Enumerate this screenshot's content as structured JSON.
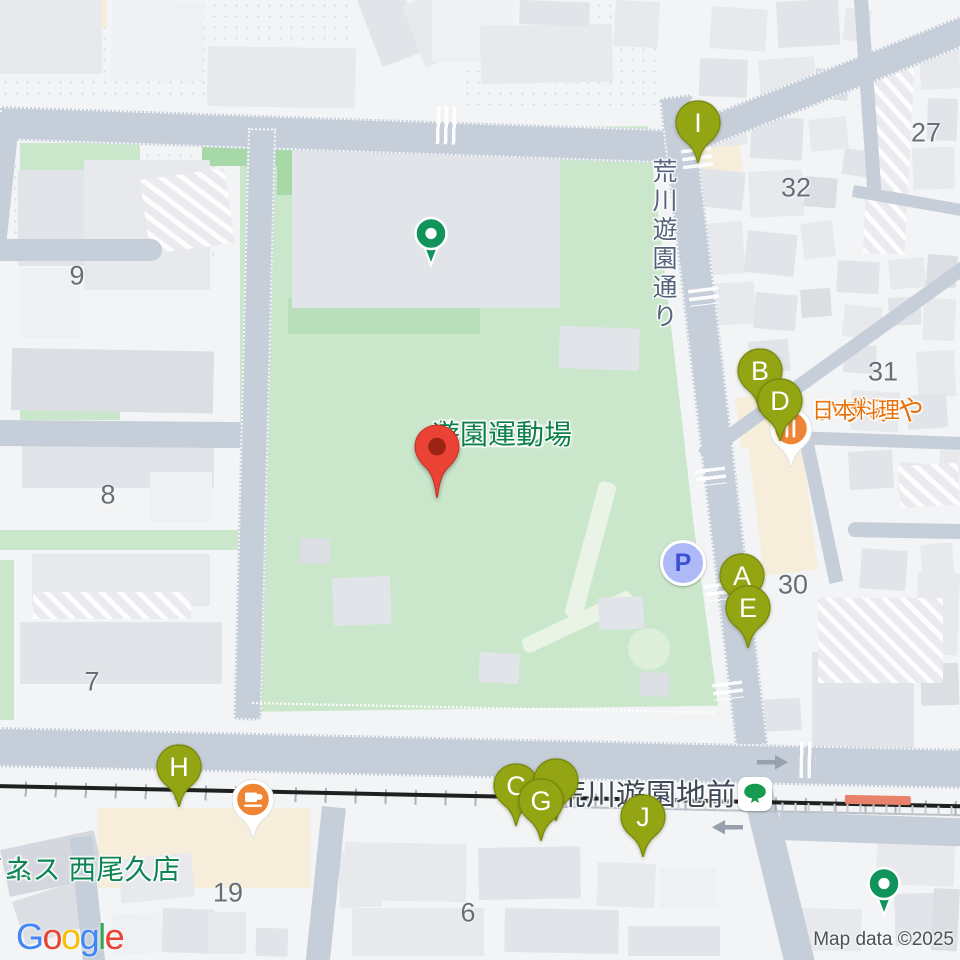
{
  "attribution": "Map data ©2025",
  "google_logo": {
    "letters": [
      {
        "ch": "G",
        "color": "#4285F4"
      },
      {
        "ch": "o",
        "color": "#EA4335"
      },
      {
        "ch": "o",
        "color": "#FBBC05"
      },
      {
        "ch": "g",
        "color": "#4285F4"
      },
      {
        "ch": "l",
        "color": "#34A853"
      },
      {
        "ch": "e",
        "color": "#EA4335"
      }
    ]
  },
  "parking_label": "P",
  "poi_labels": [
    {
      "name": "sports-house-label",
      "lines": [
        {
          "text": "あらかわ遊園",
          "size": 28
        },
        {
          "text": "スポーツハウス",
          "size": 27
        }
      ],
      "x": 402,
      "y": 203,
      "align": "right",
      "line_height": 31,
      "color": "green",
      "interactable": true
    },
    {
      "name": "ground-label",
      "lines": [
        {
          "text": "荒川区立",
          "size": 28
        },
        {
          "text": "あらかわ",
          "size": 28
        },
        {
          "text": "遊園運動場",
          "size": 28
        }
      ],
      "x": 432,
      "y": 420,
      "align": "center",
      "line_height": 29,
      "color": "green",
      "interactable": false
    },
    {
      "name": "street-name-label",
      "lines": [
        {
          "text": "荒川遊園通り",
          "size": 25
        }
      ],
      "x": 676,
      "y": 158,
      "align": "center",
      "line_height": 27,
      "color": "street",
      "vertical": true,
      "interactable": false
    },
    {
      "name": "station-name-label",
      "lines": [
        {
          "text": "荒川遊園地前",
          "size": 30
        }
      ],
      "x": 556,
      "y": 780,
      "align": "left",
      "line_height": 32,
      "color": "station",
      "interactable": true
    },
    {
      "name": "izumiya-label",
      "lines": [
        {
          "text": "いずみや",
          "size": 28
        },
        {
          "text": "日本料理",
          "size": 22
        }
      ],
      "x": 812,
      "y": 396,
      "align": "left",
      "line_height": 30,
      "color": "orange",
      "interactable": true
    },
    {
      "name": "cafe-kotetsu-label",
      "lines": [
        {
          "text": "プラレールが",
          "size": 28
        },
        {
          "text": "走るカフェ子鉄",
          "size": 28
        }
      ],
      "x": 236,
      "y": 774,
      "align": "right",
      "line_height": 32,
      "color": "orange",
      "interactable": true
    },
    {
      "name": "anytime-fitness-label",
      "lines": [
        {
          "text": "エニタイム",
          "size": 28
        },
        {
          "text": "フィットネス 西尾久店",
          "size": 28
        }
      ],
      "x": 853,
      "y": 855,
      "align": "right",
      "line_height": 30,
      "color": "green2",
      "interactable": true
    }
  ],
  "block_numbers": [
    {
      "text": "9",
      "x": 77,
      "y": 276
    },
    {
      "text": "8",
      "x": 108,
      "y": 495
    },
    {
      "text": "7",
      "x": 92,
      "y": 682
    },
    {
      "text": "19",
      "x": 228,
      "y": 893
    },
    {
      "text": "6",
      "x": 468,
      "y": 913
    },
    {
      "text": "32",
      "x": 796,
      "y": 188
    },
    {
      "text": "27",
      "x": 926,
      "y": 133
    },
    {
      "text": "31",
      "x": 883,
      "y": 372
    },
    {
      "text": "30",
      "x": 793,
      "y": 585
    }
  ],
  "markers": [
    {
      "letter": "I",
      "x": 698,
      "y": 123
    },
    {
      "letter": "B",
      "x": 760,
      "y": 371
    },
    {
      "letter": "D",
      "x": 780,
      "y": 401
    },
    {
      "letter": "A",
      "x": 742,
      "y": 576
    },
    {
      "letter": "E",
      "x": 748,
      "y": 608
    },
    {
      "letter": "H",
      "x": 179,
      "y": 767
    },
    {
      "letter": "C",
      "x": 516,
      "y": 786
    },
    {
      "letter": "",
      "x": 556,
      "y": 781
    },
    {
      "letter": "G",
      "x": 541,
      "y": 801
    },
    {
      "letter": "J",
      "x": 643,
      "y": 817
    }
  ],
  "icons": [
    {
      "name": "sports-house-poi-icon",
      "type": "greendot",
      "x": 431,
      "y": 233,
      "interactable": true
    },
    {
      "name": "fitness-poi-icon",
      "type": "greendot",
      "x": 884,
      "y": 883,
      "interactable": true
    },
    {
      "name": "restaurant-poi-icon",
      "type": "food",
      "glyph": "fork",
      "x": 791,
      "y": 428,
      "interactable": true
    },
    {
      "name": "cafe-poi-icon",
      "type": "food",
      "glyph": "cup",
      "x": 253,
      "y": 799,
      "interactable": true
    },
    {
      "name": "parking-icon",
      "type": "parking",
      "x": 683,
      "y": 563,
      "interactable": true
    },
    {
      "name": "tram-station-icon",
      "type": "tram",
      "x": 755,
      "y": 794,
      "interactable": true
    },
    {
      "name": "destination-pin-icon",
      "type": "redpin",
      "x": 437,
      "y": 447,
      "interactable": true
    },
    {
      "name": "one-way-right-arrow-icon",
      "type": "arrow",
      "dir": "right",
      "x": 772,
      "y": 762,
      "interactable": false
    },
    {
      "name": "one-way-left-arrow-icon",
      "type": "arrow",
      "dir": "left",
      "x": 728,
      "y": 827,
      "interactable": false
    }
  ],
  "colors": {
    "road": "#c5ced9",
    "park_green": "#cbe7cb",
    "marker_pin": "#93a513",
    "marker_pin_stroke": "#77880d",
    "poi_green": "#11945c",
    "poi_orange": "#ef8435",
    "label_green": "#0c8048",
    "label_orange": "#e8710a",
    "red_pin": "#EA4335",
    "red_pin_inner": "#9c2313",
    "railway": "#1f2020",
    "parking_fill": "#aeb9f8",
    "parking_letter": "#3c50d6"
  }
}
